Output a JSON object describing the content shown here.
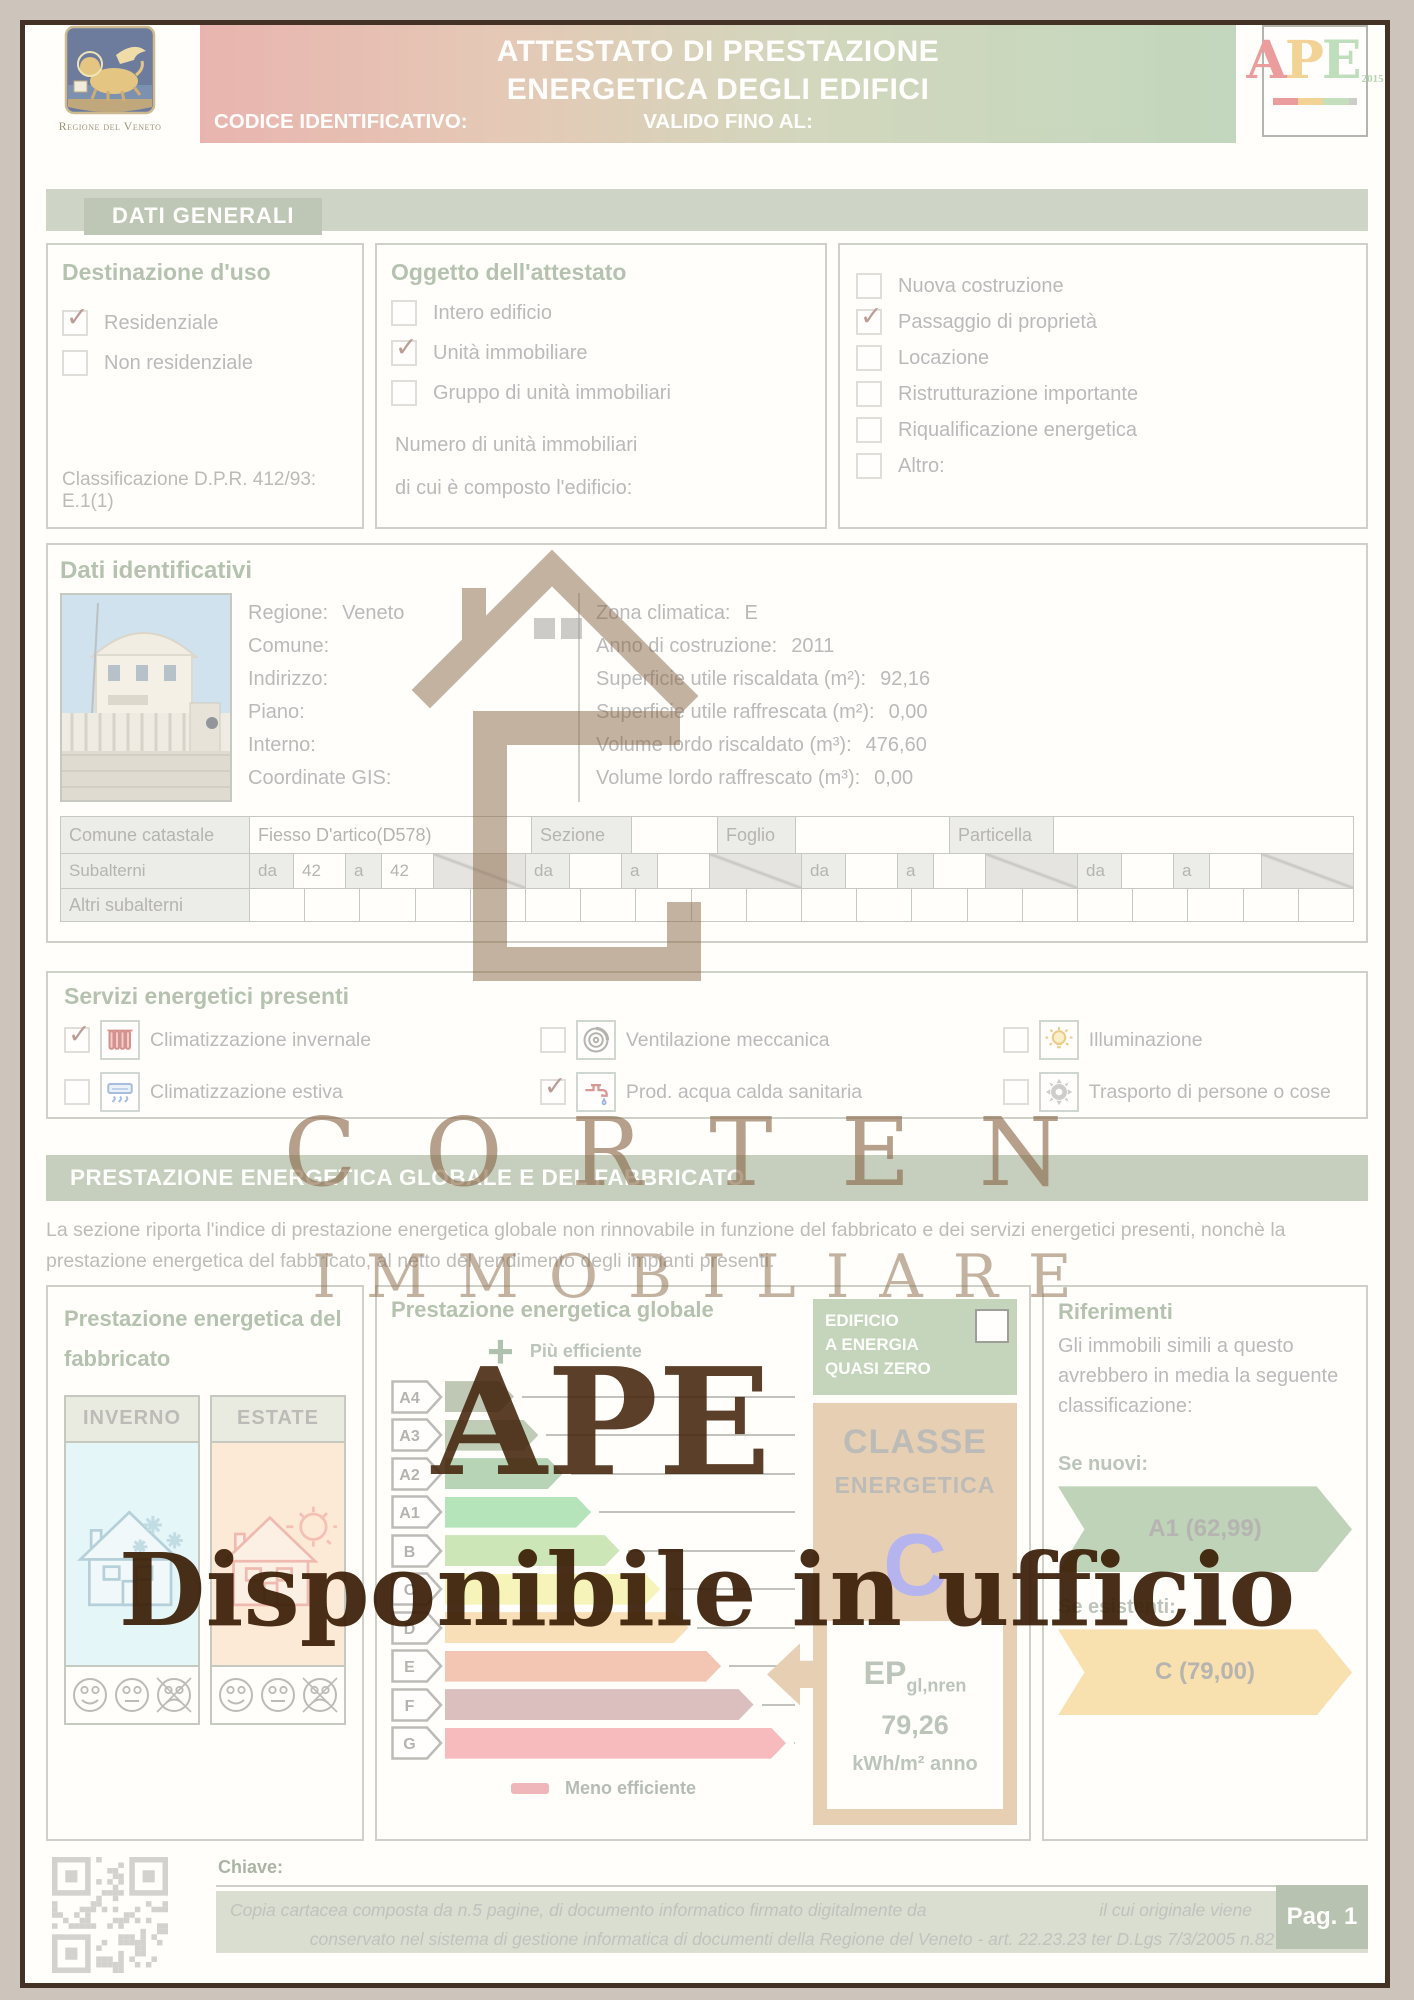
{
  "header": {
    "region_caption": "Regione del Veneto",
    "title_line1": "ATTESTATO DI PRESTAZIONE",
    "title_line2": "ENERGETICA DEGLI EDIFICI",
    "codice_label": "CODICE IDENTIFICATIVO:",
    "valido_label": "VALIDO FINO AL:",
    "ape_a": "A",
    "ape_p": "P",
    "ape_e": "E",
    "ape_year": "2015"
  },
  "sections": {
    "dati_generali": "DATI GENERALI",
    "prestazione": "PRESTAZIONE ENERGETICA GLOBALE E DEL FABBRICATO"
  },
  "destinazione": {
    "title": "Destinazione d'uso",
    "options": [
      {
        "label": "Residenziale",
        "checked": true
      },
      {
        "label": "Non residenziale",
        "checked": false
      }
    ],
    "classificazione": "Classificazione D.P.R. 412/93: E.1(1)"
  },
  "oggetto": {
    "title": "Oggetto dell'attestato",
    "options": [
      {
        "label": "Intero edificio",
        "checked": false
      },
      {
        "label": "Unità immobiliare",
        "checked": true
      },
      {
        "label": "Gruppo di unità immobiliari",
        "checked": false
      }
    ],
    "numero_line1": "Numero di unità immobiliari",
    "numero_line2": "di cui è composto l'edificio:"
  },
  "motivo": {
    "options": [
      {
        "label": "Nuova costruzione",
        "checked": false
      },
      {
        "label": "Passaggio di proprietà",
        "checked": true
      },
      {
        "label": "Locazione",
        "checked": false
      },
      {
        "label": "Ristrutturazione importante",
        "checked": false
      },
      {
        "label": "Riqualificazione energetica",
        "checked": false
      },
      {
        "label": "Altro:",
        "checked": false
      }
    ]
  },
  "dati_identificativi": {
    "title": "Dati identificativi",
    "left_fields": [
      {
        "label": "Regione:",
        "value": "Veneto"
      },
      {
        "label": "Comune:",
        "value": ""
      },
      {
        "label": "Indirizzo:",
        "value": ""
      },
      {
        "label": "Piano:",
        "value": ""
      },
      {
        "label": "Interno:",
        "value": ""
      },
      {
        "label": "Coordinate GIS:",
        "value": ""
      }
    ],
    "right_fields": [
      {
        "label": "Zona climatica:",
        "value": "E"
      },
      {
        "label": "Anno di costruzione:",
        "value": "2011"
      },
      {
        "label": "Superficie utile riscaldata (m²):",
        "value": "92,16"
      },
      {
        "label": "Superficie utile raffrescata (m²):",
        "value": "0,00"
      },
      {
        "label": "Volume lordo riscaldato (m³):",
        "value": "476,60"
      },
      {
        "label": "Volume lordo raffrescato (m³):",
        "value": "0,00"
      }
    ]
  },
  "catasto": {
    "row1": [
      {
        "text": "Comune catastale",
        "header": true
      },
      {
        "text": "Fiesso D'artico(D578)",
        "header": false
      },
      {
        "text": "Sezione",
        "header": true
      },
      {
        "text": "",
        "header": false
      },
      {
        "text": "Foglio",
        "header": true
      },
      {
        "text": "",
        "header": false
      },
      {
        "text": "Particella",
        "header": true
      },
      {
        "text": "",
        "header": false
      }
    ],
    "subalterni_label": "Subalterni",
    "da_label": "da",
    "a_label": "a",
    "groups": [
      {
        "da": "42",
        "a": "42"
      },
      {
        "da": "",
        "a": ""
      },
      {
        "da": "",
        "a": ""
      },
      {
        "da": "",
        "a": ""
      }
    ],
    "altri_label": "Altri subalterni",
    "empty_cells": 20
  },
  "servizi": {
    "title": "Servizi energetici presenti",
    "items": [
      {
        "label": "Climatizzazione invernale",
        "checked": true,
        "icon": "radiator"
      },
      {
        "label": "Ventilazione meccanica",
        "checked": false,
        "icon": "fan"
      },
      {
        "label": "Illuminazione",
        "checked": false,
        "icon": "bulb"
      },
      {
        "label": "Climatizzazione estiva",
        "checked": false,
        "icon": "ac"
      },
      {
        "label": "Prod. acqua calda sanitaria",
        "checked": true,
        "icon": "faucet"
      },
      {
        "label": "Trasporto di persone o cose",
        "checked": false,
        "icon": "gear"
      }
    ]
  },
  "prestazione_desc": "La sezione riporta l'indice di prestazione energetica globale non rinnovabile in funzione del fabbricato e dei servizi energetici presenti, nonchè la prestazione energetica del fabbricato, al netto del rendimento degli impianti presenti.",
  "fabbricato": {
    "title_line1": "Prestazione energetica del",
    "title_line2": "fabbricato",
    "inverno": "INVERNO",
    "estate": "ESTATE"
  },
  "globale": {
    "title": "Prestazione energetica globale",
    "piu_efficiente": "Più efficiente",
    "meno_efficiente": "Meno efficiente",
    "nzeb1": "EDIFICIO",
    "nzeb2": "A ENERGIA",
    "nzeb3": "QUASI ZERO",
    "classe_label1": "CLASSE",
    "classe_label2": "ENERGETICA",
    "classe_value": "C",
    "ep_label": "EP",
    "ep_sub": "gl,nren",
    "ep_value": "79,26",
    "ep_unit": "kWh/m² anno"
  },
  "energy_scale": [
    {
      "label": "A4",
      "color": "#9fac92",
      "width": 17
    },
    {
      "label": "A3",
      "color": "#9fb494",
      "width": 23
    },
    {
      "label": "A2",
      "color": "#93c193",
      "width": 29
    },
    {
      "label": "A1",
      "color": "#8fd79a",
      "width": 36
    },
    {
      "label": "B",
      "color": "#b2da94",
      "width": 43
    },
    {
      "label": "C",
      "color": "#f4f09a",
      "width": 53
    },
    {
      "label": "D",
      "color": "#f6d094",
      "width": 60
    },
    {
      "label": "E",
      "color": "#eeaa8e",
      "width": 68
    },
    {
      "label": "F",
      "color": "#c89f9f",
      "width": 76
    },
    {
      "label": "G",
      "color": "#f49aa0",
      "width": 84
    }
  ],
  "riferimenti": {
    "title": "Riferimenti",
    "desc": "Gli immobili simili a questo avrebbero in media la seguente classificazione:",
    "se_nuovi": "Se nuovi:",
    "nuovi_value": "A1  (62,99)",
    "se_esistenti": "Se esistenti:",
    "esistenti_value": "C  (79,00)"
  },
  "watermark": {
    "brand_top": "CORTEN",
    "brand_bottom": "IMMOBILIARE",
    "ape": "APE",
    "line": "Disponibile in ufficio"
  },
  "footer": {
    "chiave": "Chiave:",
    "line1a": "Copia cartacea composta da n.5 pagine, di documento informatico firmato digitalmente da",
    "line1b": "il cui originale viene",
    "line2": "conservato nel sistema di gestione informatica di documenti della Regione del Veneto - art. 22.23.23 ter D.Lgs 7/3/2005 n.82",
    "page": "Pag. 1"
  },
  "colors": {
    "band": "#b6c1ab",
    "band_title": "#9dac92",
    "classe_panel": "#dcb88f",
    "classe_letter": "#8f8fe8",
    "nzeb_green": "#a6c19c",
    "ribbon_green": "#9dbd97",
    "ribbon_yellow": "#f7d189"
  }
}
